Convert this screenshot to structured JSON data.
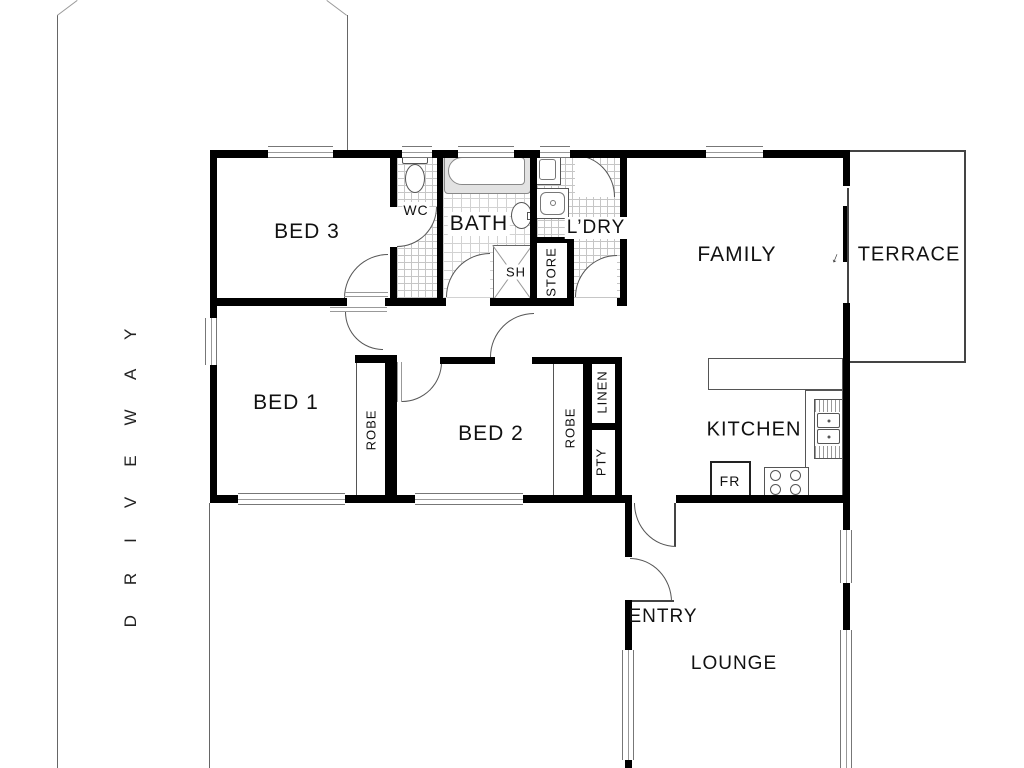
{
  "title": "Single storey house floor plan with driveway",
  "labels": {
    "driveway": "DRIVEWAY",
    "bed3": "BED 3",
    "wc": "WC",
    "bath": "BATH",
    "ldry": "L’DRY",
    "store": "STORE",
    "sh": "SH",
    "family": "FAMILY",
    "terrace": "TERRACE",
    "bed1": "BED 1",
    "bed2": "BED 2",
    "robe": "ROBE",
    "linen": "LINEN",
    "pty": "PTY",
    "kitchen": "KITCHEN",
    "fr": "FR",
    "entry": "ENTRY",
    "lounge": "LOUNGE",
    "slide_arrow": "↓"
  },
  "colors": {
    "wall": "#000000",
    "thin_line": "#555555",
    "tile_line": "#c6c6c6",
    "text": "#111111",
    "background": "#ffffff"
  }
}
